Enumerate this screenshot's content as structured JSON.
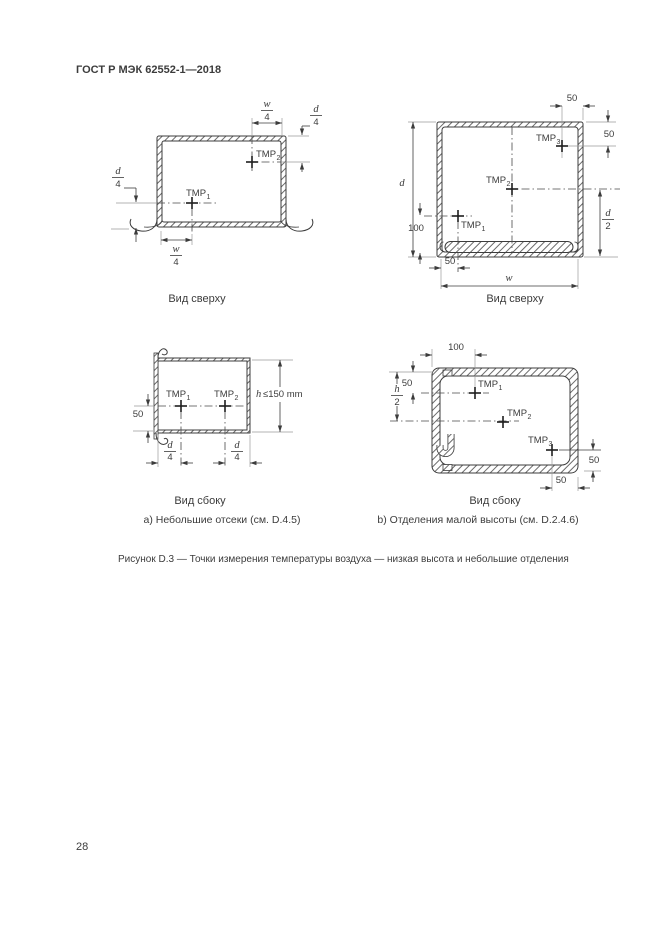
{
  "page": {
    "header": "ГОСТ Р МЭК 62552-1—2018",
    "page_number": "28",
    "caption_a": "а) Небольшие отсеки (см. D.4.5)",
    "caption_b": "b) Отделения малой высоты (см. D.2.4.6)",
    "figure_caption": "Рисунок D.3 — Точки измерения температуры воздуха — низкая высота и небольшие отделения"
  },
  "diagram_small_top": {
    "view_label": "Вид сверху",
    "tmp1_base": "TMP",
    "tmp1_sub": "1",
    "tmp2_base": "TMP",
    "tmp2_sub": "2",
    "dim_top_num": "w",
    "dim_top_den": "4",
    "dim_right_num": "d",
    "dim_right_den": "4",
    "dim_left_num": "d",
    "dim_left_den": "4",
    "dim_bottom_num": "w",
    "dim_bottom_den": "4"
  },
  "diagram_low_top": {
    "view_label": "Вид сверху",
    "tmp1_base": "TMP",
    "tmp1_sub": "1",
    "tmp2_base": "TMP",
    "tmp2_sub": "2",
    "tmp3_base": "TMP",
    "tmp3_sub": "3",
    "dim_top": "50",
    "dim_right_top": "50",
    "dim_depth": "d",
    "dim_100": "100",
    "dim_half_num": "d",
    "dim_half_den": "2",
    "dim_bottom_50": "50",
    "dim_width": "w"
  },
  "diagram_small_side": {
    "view_label": "Вид сбоку",
    "tmp1_base": "TMP",
    "tmp1_sub": "1",
    "tmp2_base": "TMP",
    "tmp2_sub": "2",
    "dim_left_50": "50",
    "height_sym": "h",
    "height_limit": "≤150 mm",
    "dim_b1_num": "d",
    "dim_b1_den": "4",
    "dim_b2_num": "d",
    "dim_b2_den": "4"
  },
  "diagram_low_side": {
    "view_label": "Вид сбоку",
    "tmp1_base": "TMP",
    "tmp1_sub": "1",
    "tmp2_base": "TMP",
    "tmp2_sub": "2",
    "tmp3_base": "TMP",
    "tmp3_sub": "3",
    "dim_top_100": "100",
    "dim_left_50": "50",
    "dim_h2_num": "h",
    "dim_h2_den": "2",
    "dim_right_50": "50",
    "dim_bottom_50": "50"
  }
}
